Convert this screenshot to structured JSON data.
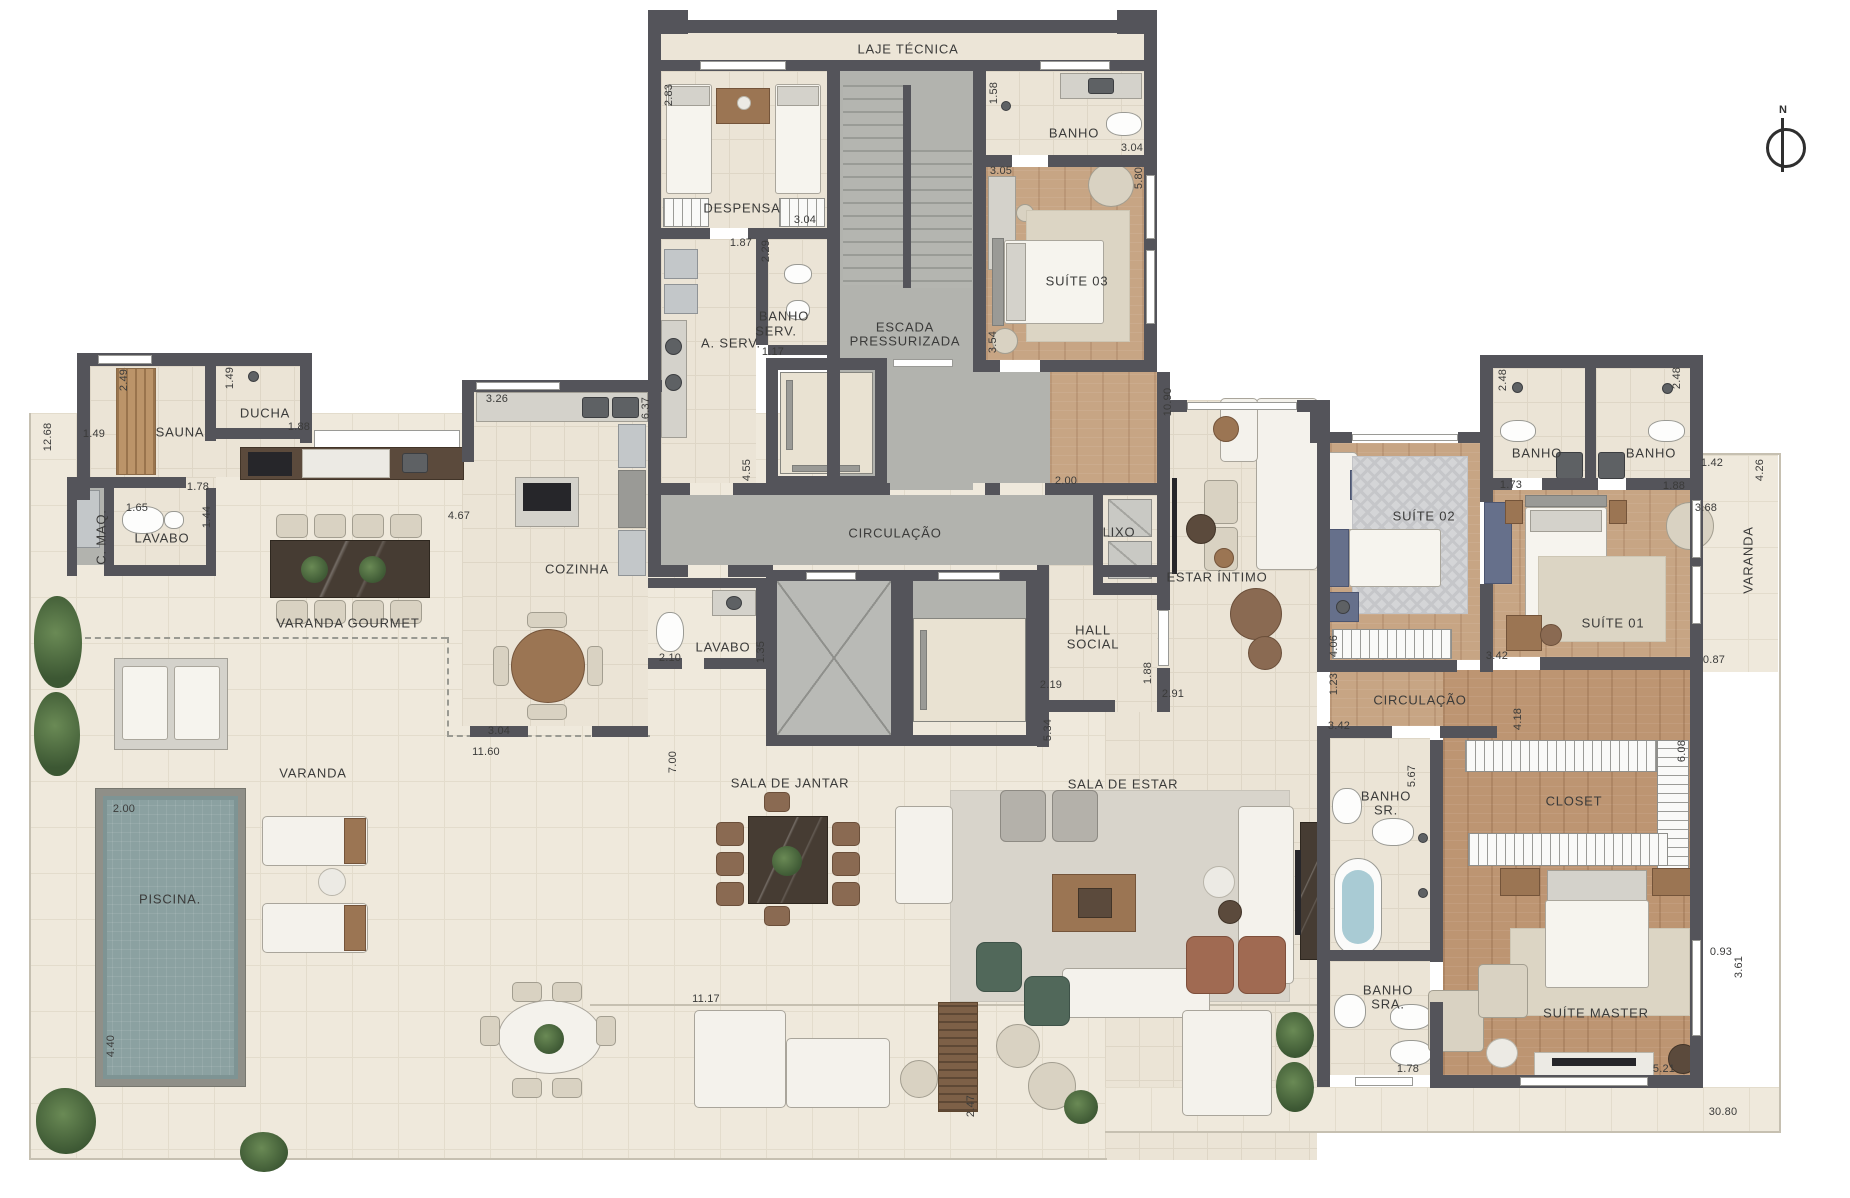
{
  "plan": {
    "type": "residential-floor-plan",
    "language": "pt-BR"
  },
  "colors": {
    "wall": "#54545a",
    "interior_floor": "#ebe4d6",
    "outdoor_floor": "#efe9dc",
    "wood_floor": "#c7a584",
    "concrete_floor": "#b2b3ae",
    "pool_water": "#8ba1a1",
    "label_text": "#3b3b3a"
  },
  "compass": {
    "label": "N"
  },
  "labels": {
    "rooms": [
      {
        "id": "laje-tecnica",
        "text": "LAJE TÉCNICA",
        "x": 908,
        "y": 49
      },
      {
        "id": "banho-suite03",
        "text": "BANHO",
        "x": 1074,
        "y": 133
      },
      {
        "id": "suite-03",
        "text": "SUÍTE 03",
        "x": 1077,
        "y": 281
      },
      {
        "id": "despensa",
        "text": "DESPENSA",
        "x": 742,
        "y": 208
      },
      {
        "id": "banho-serv-l1",
        "text": "BANHO",
        "x": 784,
        "y": 316
      },
      {
        "id": "banho-serv-l2",
        "text": "SERV.",
        "x": 776,
        "y": 331
      },
      {
        "id": "a-serv",
        "text": "A. SERV.",
        "x": 731,
        "y": 343
      },
      {
        "id": "escada-l1",
        "text": "ESCADA",
        "x": 905,
        "y": 327
      },
      {
        "id": "escada-l2",
        "text": "PRESSURIZADA",
        "x": 905,
        "y": 341
      },
      {
        "id": "sauna",
        "text": "SAUNA",
        "x": 180,
        "y": 432
      },
      {
        "id": "ducha",
        "text": "DUCHA",
        "x": 265,
        "y": 413
      },
      {
        "id": "c-maq",
        "text": "C. MAQ.",
        "x": 101,
        "y": 537,
        "rot": 1
      },
      {
        "id": "lavabo-esq",
        "text": "LAVABO",
        "x": 162,
        "y": 538
      },
      {
        "id": "varanda-gourmet",
        "text": "VARANDA GOURMET",
        "x": 348,
        "y": 623
      },
      {
        "id": "cozinha",
        "text": "COZINHA",
        "x": 577,
        "y": 569
      },
      {
        "id": "circulacao-centro",
        "text": "CIRCULAÇÃO",
        "x": 895,
        "y": 533
      },
      {
        "id": "lixo",
        "text": "LIXO",
        "x": 1119,
        "y": 532
      },
      {
        "id": "estar-intimo",
        "text": "ESTAR ÍNTIMO",
        "x": 1217,
        "y": 577
      },
      {
        "id": "hall-l1",
        "text": "HALL",
        "x": 1093,
        "y": 630
      },
      {
        "id": "hall-l2",
        "text": "SOCIAL",
        "x": 1093,
        "y": 644
      },
      {
        "id": "lavabo-centro",
        "text": "LAVABO",
        "x": 723,
        "y": 647
      },
      {
        "id": "sala-de-jantar",
        "text": "SALA DE JANTAR",
        "x": 790,
        "y": 783
      },
      {
        "id": "sala-de-estar",
        "text": "SALA DE ESTAR",
        "x": 1123,
        "y": 784
      },
      {
        "id": "varanda-esq",
        "text": "VARANDA",
        "x": 313,
        "y": 773
      },
      {
        "id": "piscina",
        "text": "PISCINA.",
        "x": 170,
        "y": 899
      },
      {
        "id": "suite-02",
        "text": "SUÍTE 02",
        "x": 1424,
        "y": 516
      },
      {
        "id": "banho-s02",
        "text": "BANHO",
        "x": 1537,
        "y": 453
      },
      {
        "id": "banho-s01",
        "text": "BANHO",
        "x": 1651,
        "y": 453
      },
      {
        "id": "suite-01",
        "text": "SUÍTE 01",
        "x": 1613,
        "y": 623
      },
      {
        "id": "varanda-dir",
        "text": "VARANDA",
        "x": 1748,
        "y": 560,
        "rot": 1
      },
      {
        "id": "circulacao-dir",
        "text": "CIRCULAÇÃO",
        "x": 1420,
        "y": 700
      },
      {
        "id": "banho-sr-l1",
        "text": "BANHO",
        "x": 1386,
        "y": 796
      },
      {
        "id": "banho-sr-l2",
        "text": "SR.",
        "x": 1386,
        "y": 810
      },
      {
        "id": "closet",
        "text": "CLOSET",
        "x": 1574,
        "y": 801
      },
      {
        "id": "banho-sra-l1",
        "text": "BANHO",
        "x": 1388,
        "y": 990
      },
      {
        "id": "banho-sra-l2",
        "text": "SRA.",
        "x": 1388,
        "y": 1004
      },
      {
        "id": "suite-master",
        "text": "SUÍTE MASTER",
        "x": 1596,
        "y": 1013
      }
    ],
    "dims": [
      {
        "text": "2.83",
        "x": 669,
        "y": 95,
        "rot": 1
      },
      {
        "text": "1.58",
        "x": 994,
        "y": 93,
        "rot": 1
      },
      {
        "text": "3.04",
        "x": 1132,
        "y": 148
      },
      {
        "text": "3.05",
        "x": 1001,
        "y": 171
      },
      {
        "text": "5.80",
        "x": 1139,
        "y": 178,
        "rot": 1
      },
      {
        "text": "3.04",
        "x": 805,
        "y": 220
      },
      {
        "text": "1.87",
        "x": 741,
        "y": 243
      },
      {
        "text": "2.29",
        "x": 766,
        "y": 251,
        "rot": 1
      },
      {
        "text": "1.17",
        "x": 773,
        "y": 352
      },
      {
        "text": "3.54",
        "x": 993,
        "y": 342,
        "rot": 1
      },
      {
        "text": "2.49",
        "x": 124,
        "y": 380,
        "rot": 1
      },
      {
        "text": "1.49",
        "x": 230,
        "y": 378,
        "rot": 1
      },
      {
        "text": "12.68",
        "x": 48,
        "y": 437,
        "rot": 1
      },
      {
        "text": "1.49",
        "x": 94,
        "y": 434
      },
      {
        "text": "1.88",
        "x": 299,
        "y": 427
      },
      {
        "text": "1.78",
        "x": 198,
        "y": 487
      },
      {
        "text": "1.65",
        "x": 137,
        "y": 508
      },
      {
        "text": "1.44",
        "x": 207,
        "y": 517,
        "rot": 1
      },
      {
        "text": "3.26",
        "x": 497,
        "y": 399
      },
      {
        "text": "6.37",
        "x": 646,
        "y": 408,
        "rot": 1
      },
      {
        "text": "4.67",
        "x": 459,
        "y": 516
      },
      {
        "text": "4.55",
        "x": 747,
        "y": 470,
        "rot": 1
      },
      {
        "text": "2.00",
        "x": 1066,
        "y": 481
      },
      {
        "text": "10.90",
        "x": 1168,
        "y": 402,
        "rot": 1
      },
      {
        "text": "2.10",
        "x": 670,
        "y": 658
      },
      {
        "text": "1.35",
        "x": 761,
        "y": 652,
        "rot": 1
      },
      {
        "text": "2.19",
        "x": 1051,
        "y": 685
      },
      {
        "text": "1.88",
        "x": 1148,
        "y": 673,
        "rot": 1
      },
      {
        "text": "2.91",
        "x": 1173,
        "y": 694
      },
      {
        "text": "5.34",
        "x": 1048,
        "y": 730,
        "rot": 1
      },
      {
        "text": "3.04",
        "x": 499,
        "y": 731
      },
      {
        "text": "11.60",
        "x": 486,
        "y": 752
      },
      {
        "text": "7.00",
        "x": 673,
        "y": 762,
        "rot": 1
      },
      {
        "text": "2.00",
        "x": 124,
        "y": 809
      },
      {
        "text": "4.40",
        "x": 111,
        "y": 1046,
        "rot": 1
      },
      {
        "text": "11.17",
        "x": 706,
        "y": 999
      },
      {
        "text": "2.47",
        "x": 971,
        "y": 1106,
        "rot": 1
      },
      {
        "text": "2.48",
        "x": 1503,
        "y": 380,
        "rot": 1
      },
      {
        "text": "1.73",
        "x": 1511,
        "y": 485
      },
      {
        "text": "2.48",
        "x": 1677,
        "y": 378,
        "rot": 1
      },
      {
        "text": "1.88",
        "x": 1674,
        "y": 486
      },
      {
        "text": "1.42",
        "x": 1712,
        "y": 463
      },
      {
        "text": "4.26",
        "x": 1760,
        "y": 470,
        "rot": 1
      },
      {
        "text": "3.68",
        "x": 1706,
        "y": 508
      },
      {
        "text": "0.87",
        "x": 1714,
        "y": 660
      },
      {
        "text": "4.06",
        "x": 1334,
        "y": 646,
        "rot": 1
      },
      {
        "text": "3.42",
        "x": 1497,
        "y": 656
      },
      {
        "text": "1.23",
        "x": 1334,
        "y": 684,
        "rot": 1
      },
      {
        "text": "4.18",
        "x": 1518,
        "y": 719,
        "rot": 1
      },
      {
        "text": "3.42",
        "x": 1339,
        "y": 726
      },
      {
        "text": "6.08",
        "x": 1682,
        "y": 751,
        "rot": 1
      },
      {
        "text": "5.67",
        "x": 1412,
        "y": 776,
        "rot": 1
      },
      {
        "text": "1.78",
        "x": 1408,
        "y": 1069
      },
      {
        "text": "5.21",
        "x": 1664,
        "y": 1069
      },
      {
        "text": "0.93",
        "x": 1721,
        "y": 952
      },
      {
        "text": "3.61",
        "x": 1739,
        "y": 967,
        "rot": 1
      },
      {
        "text": "30.80",
        "x": 1723,
        "y": 1112
      }
    ]
  }
}
